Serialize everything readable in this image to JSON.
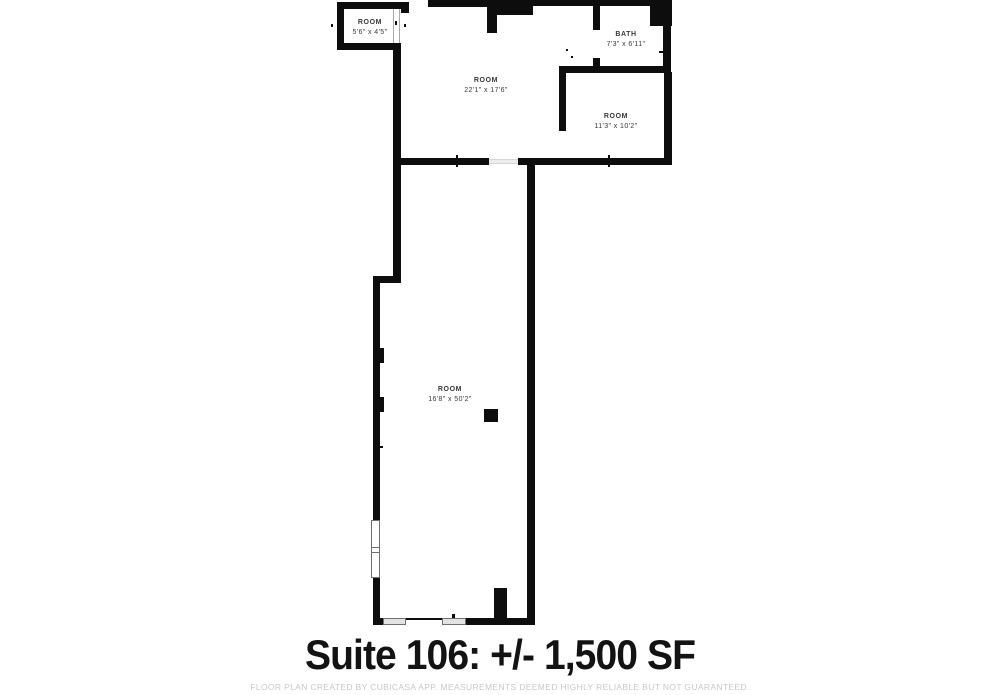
{
  "title": {
    "text": "Suite 106: +/- 1,500 SF"
  },
  "footer": {
    "text": "FLOOR PLAN CREATED BY CUBICASA APP. MEASUREMENTS DEEMED HIGHLY RELIABLE BUT NOT GUARANTEED."
  },
  "floorplan": {
    "wall_color": "#0d0d0d",
    "window_fill": "#e3e3e3",
    "label_color": "#383838",
    "rooms": [
      {
        "id": "room-top-left",
        "label": "ROOM",
        "dims": "5'6\" x 4'5\""
      },
      {
        "id": "room-main",
        "label": "ROOM",
        "dims": "22'1\" x 17'6\""
      },
      {
        "id": "bath",
        "label": "BATH",
        "dims": "7'3\" x 6'11\""
      },
      {
        "id": "room-right",
        "label": "ROOM",
        "dims": "11'3\" x 10'2\""
      },
      {
        "id": "room-long",
        "label": "ROOM",
        "dims": "16'8\" x 50'2\""
      }
    ]
  }
}
